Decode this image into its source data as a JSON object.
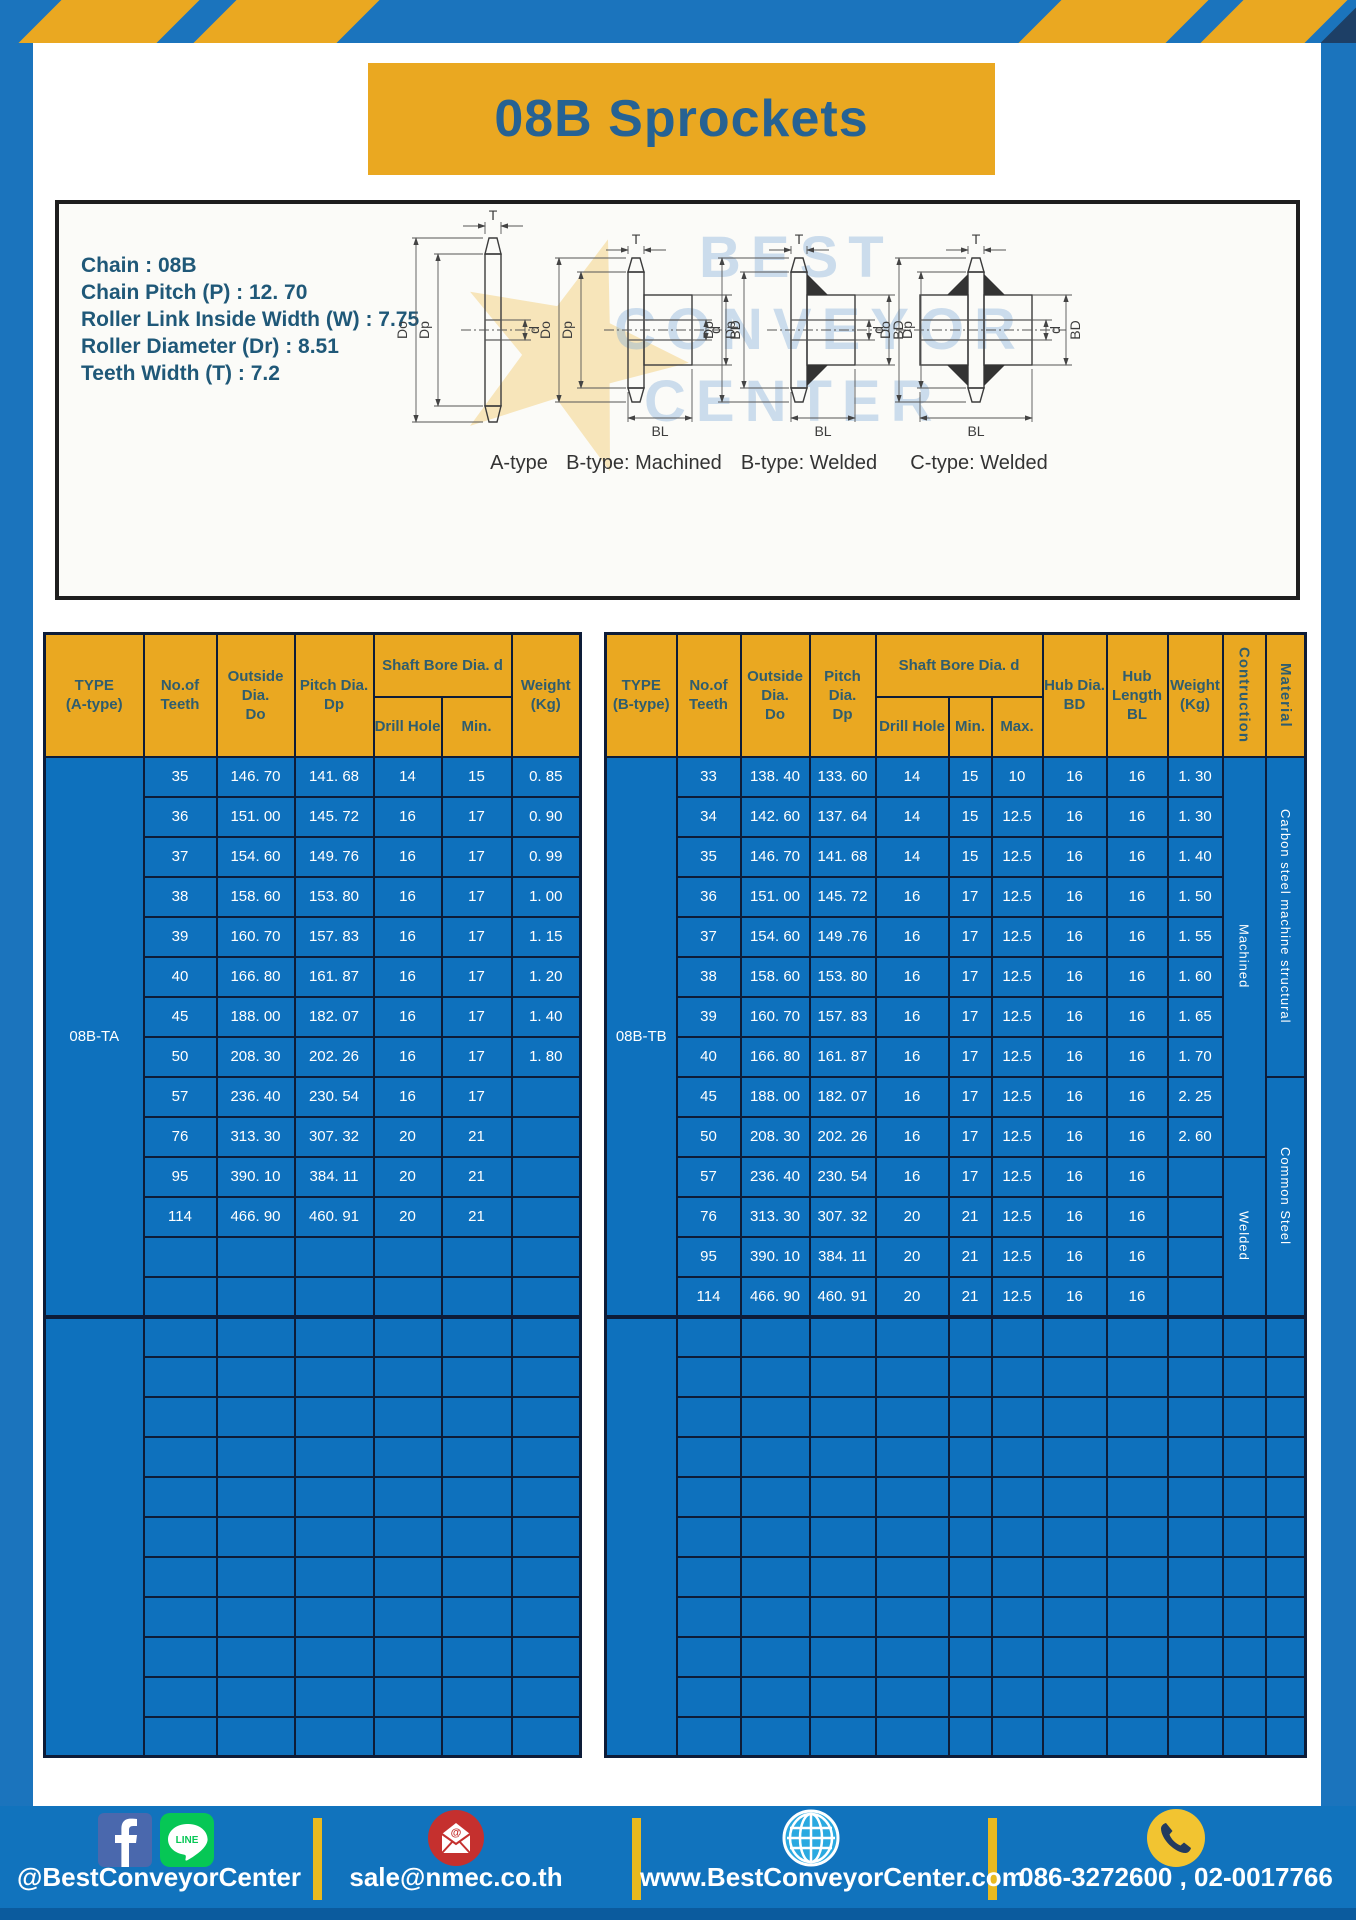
{
  "page": {
    "title": "08B Sprockets"
  },
  "colors": {
    "frame_blue": "#1b74bd",
    "accent_yellow": "#eaa821",
    "table_blue": "#0e71bd",
    "line_navy": "#0d1c38",
    "footer_blue": "#1173bd",
    "title_text": "#266293"
  },
  "specs": {
    "lines": [
      "Chain : 08B",
      "Chain Pitch (P) : 12. 70",
      "Roller Link Inside Width (W) : 7.75",
      "Roller Diameter (Dr) : 8.51",
      "Teeth Width (T) : 7.2"
    ]
  },
  "watermark": {
    "lines": [
      "BEST",
      "CONVEYOR",
      "CENTER"
    ]
  },
  "diagram": {
    "dims": {
      "T": "T",
      "Do": "Do",
      "Dp": "Dp",
      "d": "d",
      "BD": "BD",
      "BL": "BL"
    },
    "labels": [
      "A-type",
      "B-type: Machined",
      "B-type: Welded",
      "C-type: Welded"
    ]
  },
  "tables": {
    "left": {
      "headers": {
        "type": [
          "TYPE",
          "(A-type)"
        ],
        "teeth": [
          "No.of",
          "Teeth"
        ],
        "outside": [
          "Outside",
          "Dia.",
          "Do"
        ],
        "pitch": [
          "Pitch Dia.",
          "Dp"
        ],
        "shaft_bore": "Shaft Bore Dia. d",
        "drill": "Drill Hole",
        "min": "Min.",
        "weight": [
          "Weight",
          "(Kg)"
        ]
      },
      "group1": {
        "label": "08B-TA",
        "rows": [
          [
            "35",
            "146. 70",
            "141. 68",
            "14",
            "15",
            "0. 85"
          ],
          [
            "36",
            "151. 00",
            "145. 72",
            "16",
            "17",
            "0. 90"
          ],
          [
            "37",
            "154. 60",
            "149. 76",
            "16",
            "17",
            "0. 99"
          ],
          [
            "38",
            "158. 60",
            "153. 80",
            "16",
            "17",
            "1. 00"
          ],
          [
            "39",
            "160. 70",
            "157. 83",
            "16",
            "17",
            "1. 15"
          ],
          [
            "40",
            "166. 80",
            "161. 87",
            "16",
            "17",
            "1. 20"
          ],
          [
            "45",
            "188. 00",
            "182. 07",
            "16",
            "17",
            "1. 40"
          ],
          [
            "50",
            "208. 30",
            "202. 26",
            "16",
            "17",
            "1. 80"
          ],
          [
            "57",
            "236. 40",
            "230. 54",
            "16",
            "17",
            ""
          ],
          [
            "76",
            "313. 30",
            "307. 32",
            "20",
            "21",
            ""
          ],
          [
            "95",
            "390. 10",
            "384. 11",
            "20",
            "21",
            ""
          ],
          [
            "114",
            "466. 90",
            "460. 91",
            "20",
            "21",
            ""
          ],
          [
            "",
            "",
            "",
            "",
            "",
            ""
          ],
          [
            "",
            "",
            "",
            "",
            "",
            ""
          ]
        ]
      },
      "group2": {
        "rows": 11,
        "cols": 6
      }
    },
    "right": {
      "headers": {
        "type": [
          "TYPE",
          "(B-type)"
        ],
        "teeth": [
          "No.of",
          "Teeth"
        ],
        "outside": [
          "Outside",
          "Dia.",
          "Do"
        ],
        "pitch": [
          "Pitch Dia.",
          "Dp"
        ],
        "shaft_bore": "Shaft Bore Dia. d",
        "drill": "Drill Hole",
        "min": "Min.",
        "max": "Max.",
        "hub_dia": [
          "Hub Dia.",
          "BD"
        ],
        "hub_len": [
          "Hub",
          "Length",
          "BL"
        ],
        "weight": [
          "Weight",
          "(Kg)"
        ],
        "construction": "Contruction",
        "material": "Material"
      },
      "group1": {
        "label": "08B-TB",
        "rows": [
          [
            "33",
            "138. 40",
            "133. 60",
            "14",
            "15",
            "10",
            "16",
            "16",
            "1. 30"
          ],
          [
            "34",
            "142. 60",
            "137. 64",
            "14",
            "15",
            "12.5",
            "16",
            "16",
            "1. 30"
          ],
          [
            "35",
            "146. 70",
            "141. 68",
            "14",
            "15",
            "12.5",
            "16",
            "16",
            "1. 40"
          ],
          [
            "36",
            "151. 00",
            "145. 72",
            "16",
            "17",
            "12.5",
            "16",
            "16",
            "1. 50"
          ],
          [
            "37",
            "154. 60",
            "149 .76",
            "16",
            "17",
            "12.5",
            "16",
            "16",
            "1. 55"
          ],
          [
            "38",
            "158. 60",
            "153. 80",
            "16",
            "17",
            "12.5",
            "16",
            "16",
            "1. 60"
          ],
          [
            "39",
            "160. 70",
            "157. 83",
            "16",
            "17",
            "12.5",
            "16",
            "16",
            "1. 65"
          ],
          [
            "40",
            "166. 80",
            "161. 87",
            "16",
            "17",
            "12.5",
            "16",
            "16",
            "1. 70"
          ],
          [
            "45",
            "188. 00",
            "182. 07",
            "16",
            "17",
            "12.5",
            "16",
            "16",
            "2. 25"
          ],
          [
            "50",
            "208. 30",
            "202. 26",
            "16",
            "17",
            "12.5",
            "16",
            "16",
            "2. 60"
          ],
          [
            "57",
            "236. 40",
            "230. 54",
            "16",
            "17",
            "12.5",
            "16",
            "16",
            ""
          ],
          [
            "76",
            "313. 30",
            "307. 32",
            "20",
            "21",
            "12.5",
            "16",
            "16",
            ""
          ],
          [
            "95",
            "390. 10",
            "384. 11",
            "20",
            "21",
            "12.5",
            "16",
            "16",
            ""
          ],
          [
            "114",
            "466. 90",
            "460. 91",
            "20",
            "21",
            "12.5",
            "16",
            "16",
            ""
          ]
        ],
        "construction": [
          {
            "text": "Machined",
            "span": 10
          },
          {
            "text": "Welded",
            "span": 4
          }
        ],
        "material": [
          {
            "text": "Carbon steel  machine structural",
            "span": 8
          },
          {
            "text": "Common  Steel",
            "span": 6
          }
        ]
      },
      "group2": {
        "rows": 11,
        "cols": 11
      }
    }
  },
  "footer": {
    "facebook_line_handle": "@BestConveyorCenter",
    "line_label": "LINE",
    "email": "sale@nmec.co.th",
    "website": "www.BestConveyorCenter.com",
    "phones": "086-3272600 , 02-0017766"
  }
}
